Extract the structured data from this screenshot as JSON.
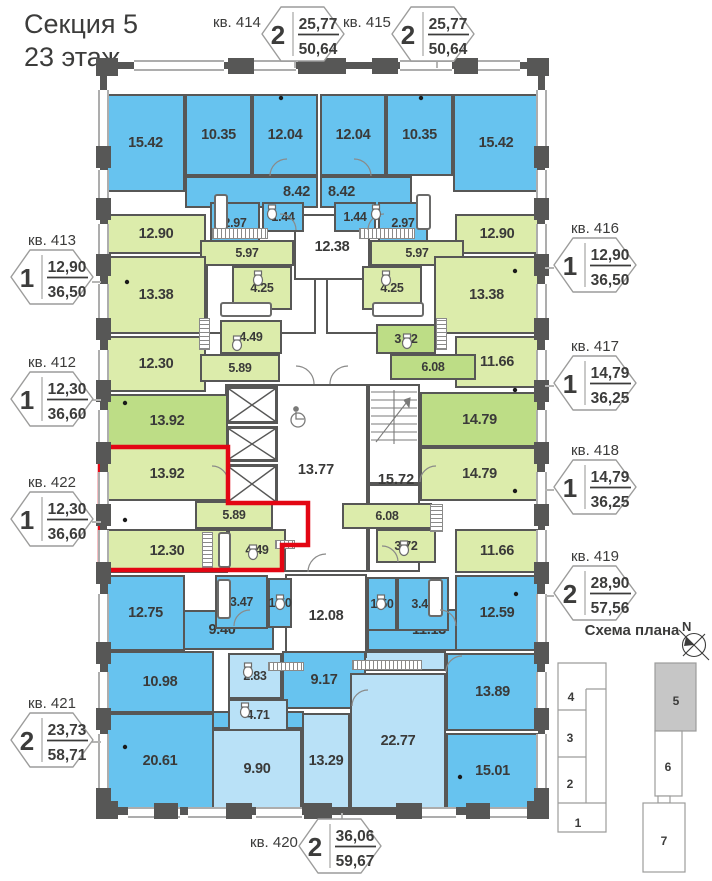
{
  "title": {
    "section": "Секция 5",
    "floor": "23 этаж"
  },
  "apartments": [
    {
      "id": "413",
      "label": "кв. 413",
      "rooms": "1",
      "living": "12,90",
      "total": "36,50"
    },
    {
      "id": "412",
      "label": "кв. 412",
      "rooms": "1",
      "living": "12,30",
      "total": "36,60"
    },
    {
      "id": "422",
      "label": "кв. 422",
      "rooms": "1",
      "living": "12,30",
      "total": "36,60",
      "highlighted": true
    },
    {
      "id": "421",
      "label": "кв. 421",
      "rooms": "2",
      "living": "23,73",
      "total": "58,71"
    },
    {
      "id": "414",
      "label": "кв. 414",
      "rooms": "2",
      "living": "25,77",
      "total": "50,64"
    },
    {
      "id": "415",
      "label": "кв. 415",
      "rooms": "2",
      "living": "25,77",
      "total": "50,64"
    },
    {
      "id": "416",
      "label": "кв. 416",
      "rooms": "1",
      "living": "12,90",
      "total": "36,50"
    },
    {
      "id": "417",
      "label": "кв. 417",
      "rooms": "1",
      "living": "14,79",
      "total": "36,25"
    },
    {
      "id": "418",
      "label": "кв. 418",
      "rooms": "1",
      "living": "14,79",
      "total": "36,25"
    },
    {
      "id": "419",
      "label": "кв. 419",
      "rooms": "2",
      "living": "28,90",
      "total": "57,56"
    },
    {
      "id": "420",
      "label": "кв. 420",
      "rooms": "2",
      "living": "36,06",
      "total": "59,67"
    }
  ],
  "rooms": [
    {
      "area": "15.42"
    },
    {
      "area": "10.35"
    },
    {
      "area": "12.04"
    },
    {
      "area": "8.42"
    },
    {
      "area": "2.97"
    },
    {
      "area": "1.44"
    },
    {
      "area": "12.04"
    },
    {
      "area": "10.35"
    },
    {
      "area": "15.42"
    },
    {
      "area": "8.42"
    },
    {
      "area": "1.44"
    },
    {
      "area": "2.97"
    },
    {
      "area": "12.90"
    },
    {
      "area": "5.97"
    },
    {
      "area": "13.38"
    },
    {
      "area": "4.25"
    },
    {
      "area": "12.38"
    },
    {
      "area": "12.90"
    },
    {
      "area": "5.97"
    },
    {
      "area": "13.38"
    },
    {
      "area": "4.25"
    },
    {
      "area": "12.30"
    },
    {
      "area": "4.49"
    },
    {
      "area": "5.89"
    },
    {
      "area": "11.66"
    },
    {
      "area": "3.72"
    },
    {
      "area": "6.08"
    },
    {
      "area": "13.92"
    },
    {
      "area": "14.79"
    },
    {
      "area": "13.77"
    },
    {
      "area": "15.72"
    },
    {
      "area": "13.92"
    },
    {
      "area": "5.89"
    },
    {
      "area": "12.30"
    },
    {
      "area": "4.49"
    },
    {
      "area": "14.79"
    },
    {
      "area": "6.08"
    },
    {
      "area": "3.72"
    },
    {
      "area": "11.66"
    },
    {
      "area": "12.75"
    },
    {
      "area": "3.47"
    },
    {
      "area": "1.50"
    },
    {
      "area": "9.40"
    },
    {
      "area": "12.08"
    },
    {
      "area": "1.50"
    },
    {
      "area": "3.44"
    },
    {
      "area": "11.13"
    },
    {
      "area": "12.59"
    },
    {
      "area": "10.98"
    },
    {
      "area": "2.83"
    },
    {
      "area": "9.17"
    },
    {
      "area": "4.71"
    },
    {
      "area": "20.61"
    },
    {
      "area": "9.90"
    },
    {
      "area": "13.29"
    },
    {
      "area": "22.77"
    },
    {
      "area": "13.89"
    },
    {
      "area": "15.01"
    }
  ],
  "minimap": {
    "title": "Схема плана",
    "north": "N",
    "sections": [
      {
        "num": "4"
      },
      {
        "num": "3"
      },
      {
        "num": "2"
      },
      {
        "num": "1"
      },
      {
        "num": "5",
        "active": true
      },
      {
        "num": "6"
      },
      {
        "num": "7"
      }
    ]
  },
  "colors": {
    "room_blue": "#67c3ef",
    "room_blue_light": "#b9e1f7",
    "room_green": "#dcecab",
    "room_green_dark": "#bddd86",
    "wall": "#575756",
    "highlight_red": "#e30613",
    "minimap_active": "#c6c6c6"
  }
}
